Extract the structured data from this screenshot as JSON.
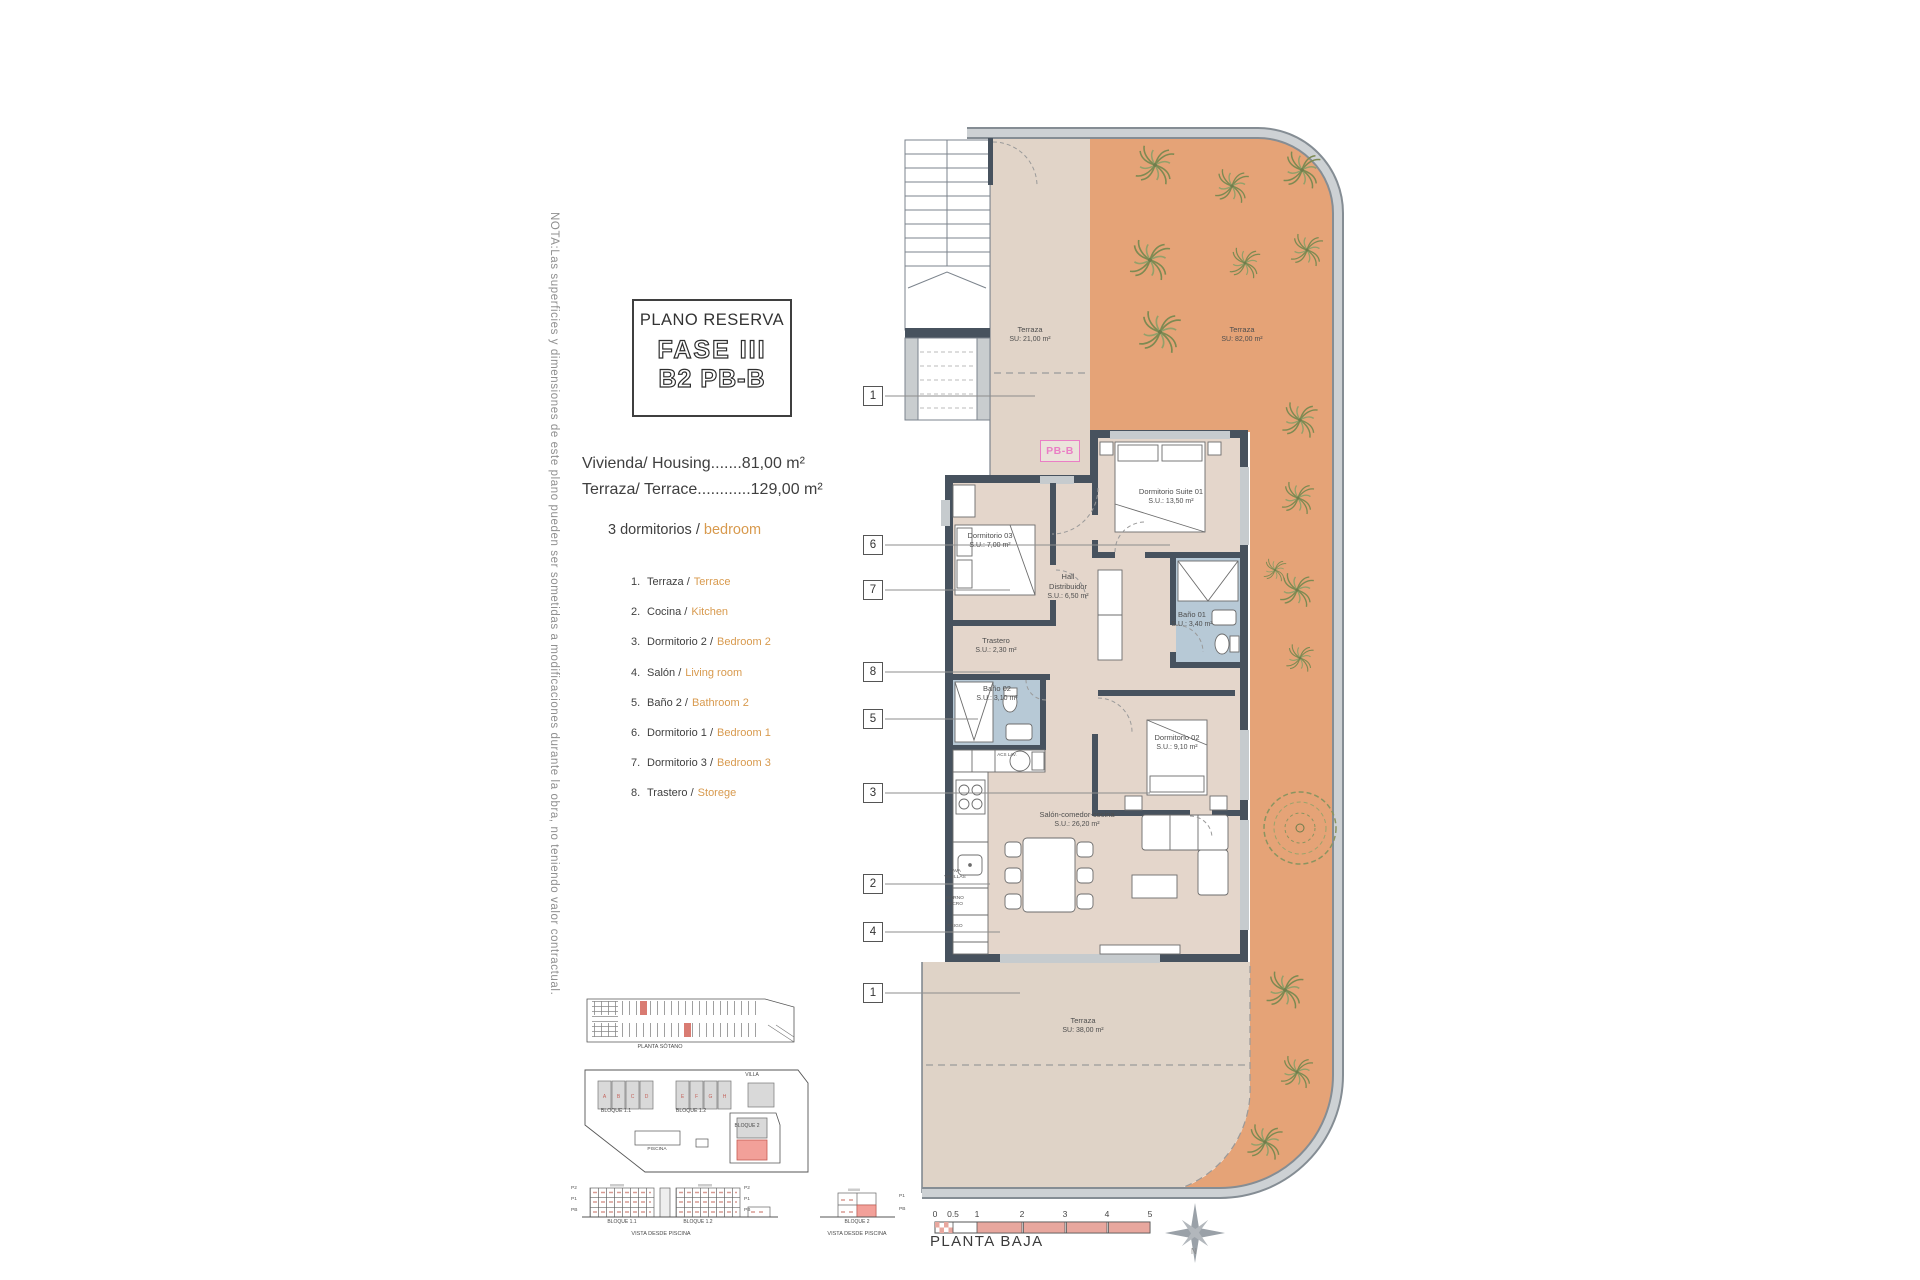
{
  "note": "NOTA:Las superficies y dimensiones de este plano pueden ser sometidas a modificaciones durante la obra, no teniendo valor contractual.",
  "title_box": {
    "heading": "PLANO RESERVA",
    "phase": "FASE III",
    "unit": "B2 PB-B"
  },
  "areas": {
    "housing": "Vivienda/ Housing.......81,00 m²",
    "terrace": "Terraza/ Terrace............129,00 m²"
  },
  "bedrooms": {
    "es": "3 dormitorios /",
    "en": "bedroom"
  },
  "legend": [
    {
      "num": "1.",
      "es": "Terraza /",
      "en": "Terrace"
    },
    {
      "num": "2.",
      "es": "Cocina /",
      "en": "Kitchen"
    },
    {
      "num": "3.",
      "es": "Dormitorio 2 /",
      "en": "Bedroom 2"
    },
    {
      "num": "4.",
      "es": "Salón /",
      "en": "Living room"
    },
    {
      "num": "5.",
      "es": "Baño 2 /",
      "en": "Bathroom 2"
    },
    {
      "num": "6.",
      "es": "Dormitorio 1 /",
      "en": "Bedroom 1"
    },
    {
      "num": "7.",
      "es": "Dormitorio 3 /",
      "en": "Bedroom 3"
    },
    {
      "num": "8.",
      "es": "Trastero /",
      "en": "Storege"
    }
  ],
  "plan": {
    "unit_tag": "PB-B",
    "rooms": {
      "terraza_top": {
        "name": "Terraza",
        "area": "SU: 21,00 m²"
      },
      "terraza_right": {
        "name": "Terraza",
        "area": "SU: 82,00 m²"
      },
      "suite": {
        "name": "Dormitorio Suite 01",
        "area": "S.U.: 13,50 m²"
      },
      "dorm03": {
        "name": "Dormitorio 03",
        "area": "S.U.: 7,00 m²"
      },
      "hall": {
        "line1": "Hall",
        "line2": "Distribuidor",
        "area": "S.U.: 6,50 m²"
      },
      "bano01": {
        "name": "Baño 01",
        "area": "S.U.: 3,40 m²"
      },
      "trastero": {
        "name": "Trastero",
        "area": "S.U.: 2,30 m²"
      },
      "bano02": {
        "name": "Baño 02",
        "area": "S.U.: 3,10 m²"
      },
      "dorm02": {
        "name": "Dormitorio 02",
        "area": "S.U.: 9,10 m²"
      },
      "salon": {
        "name": "Salón-comedor-cocina",
        "area": "S.U.: 26,20 m²"
      },
      "terraza_bottom": {
        "name": "Terraza",
        "area": "SU: 38,00 m²"
      }
    },
    "tags": [
      "1",
      "6",
      "7",
      "8",
      "5",
      "3",
      "2",
      "4",
      "1"
    ],
    "kitchen": {
      "dishwasher": "LAVA VAJILLAS",
      "oven": "HORNO MICRO",
      "fridge": "FRIGO",
      "water_heater": "ACS LAV."
    },
    "colors": {
      "terrace_orange": "#E5A377",
      "floor_beige": "#E4D6CB",
      "wall_dark": "#47525E",
      "bath_blue": "#B7C9D6",
      "unit_pink": "#EA7EC5",
      "accent_orange": "#D89A4E",
      "scale_pink": "#E8A79E"
    }
  },
  "site": {
    "basement": "PLANTA SÓTANO",
    "b11": "BLOQUE 1.1",
    "b12": "BLOQUE 1.2",
    "b2": "BLOQUE 2",
    "villa": "VILLA",
    "pool": "PISCINA",
    "b11_letters": [
      "A",
      "B",
      "C",
      "D"
    ],
    "b12_letters": [
      "E",
      "F",
      "G",
      "H"
    ],
    "elev": {
      "b11": "BLOQUE 1.1",
      "b12": "BLOQUE 1.2",
      "b2": "BLOQUE 2",
      "view1": "VISTA DESDE PISCINA",
      "view2": "VISTA DESDE PISCINA",
      "floors": [
        "P2",
        "P1",
        "PB"
      ],
      "floors_b2": [
        "P1",
        "PB"
      ]
    }
  },
  "footer": {
    "plan_name": "PLANTA BAJA",
    "scale": [
      "0",
      "0.5",
      "1",
      "2",
      "3",
      "4",
      "5"
    ],
    "north": "N"
  }
}
